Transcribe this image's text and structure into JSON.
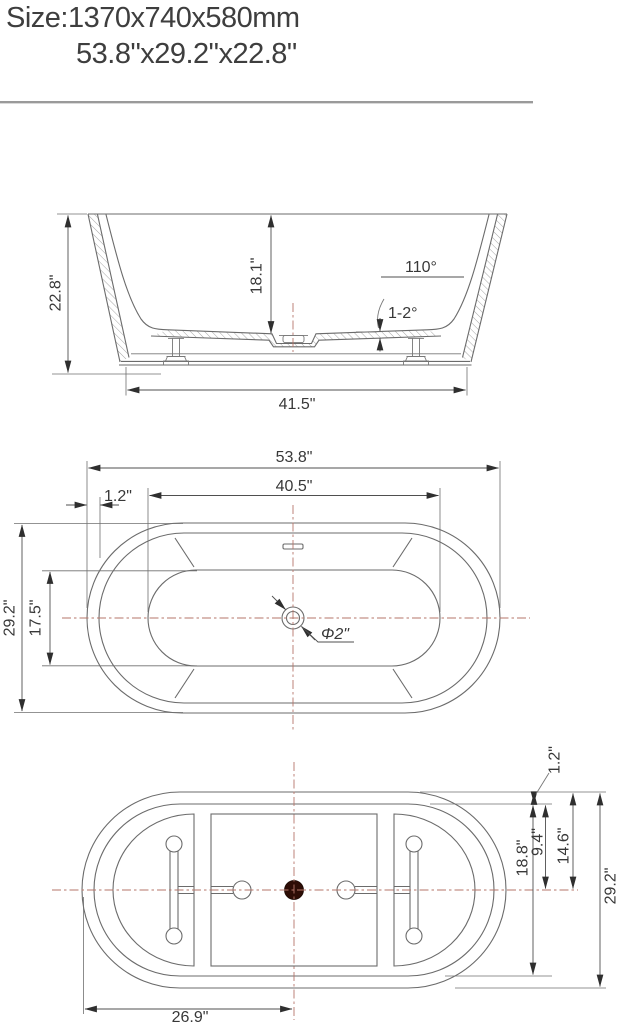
{
  "title": {
    "line1": "Size:1370x740x580mm",
    "line2": "53.8\"x29.2\"x22.8\""
  },
  "colors": {
    "drawing_line": "#6b6b6b",
    "dimension_line": "#4f4f4f",
    "text": "#383838",
    "centerline": "#b5766a",
    "drain_fill": "#2e0d06",
    "divider": "#9a9a9a"
  },
  "side_view": {
    "overall_height": "22.8\"",
    "inner_depth": "18.1\"",
    "wall_angle": "110°",
    "floor_slope": "1-2°",
    "base_width": "41.5\""
  },
  "plan_view": {
    "overall_length": "53.8\"",
    "basin_length": "40.5\"",
    "rim_width": "1.2\"",
    "overall_width": "29.2\"",
    "basin_width": "17.5\"",
    "drain_diameter": "Φ2\""
  },
  "bottom_view": {
    "rim_width": "1.2\"",
    "half_basin_width": "9.4\"",
    "half_overall_width": "14.6\"",
    "basin_width": "18.8\"",
    "overall_width": "29.2\"",
    "half_length": "26.9\""
  }
}
